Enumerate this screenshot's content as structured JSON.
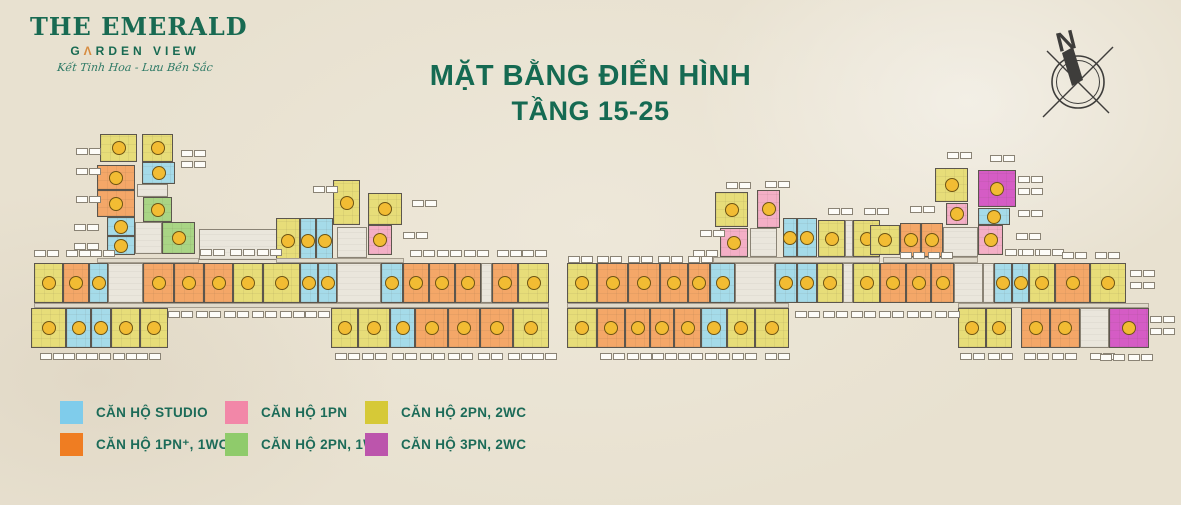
{
  "logo": {
    "line1": "THE EMERALD",
    "line2_pre": "G",
    "line2_a": "Λ",
    "line2_post": "RDEN VIEW",
    "tagline": "Kết Tinh Hoa - Lưu Bền Sắc"
  },
  "title": {
    "line1": "MẶT BẰNG  ĐIỂN HÌNH",
    "line2": "TẦNG 15-25"
  },
  "compass": {
    "label": "N"
  },
  "legend": {
    "items": [
      {
        "key": "studio",
        "label": "CĂN HỘ STUDIO",
        "color": "#7FCCEB"
      },
      {
        "key": "1pn_plus",
        "label": "CĂN HỘ 1PN⁺, 1WC",
        "color": "#EF7D22"
      },
      {
        "key": "1pn",
        "label": "CĂN HỘ 1PN",
        "color": "#F287A8"
      },
      {
        "key": "2pn_1wc",
        "label": "CĂN HỘ 2PN, 1WC",
        "color": "#8FCB6B"
      },
      {
        "key": "2pn_2wc",
        "label": "CĂN HỘ 2PN, 2WC",
        "color": "#D6C937"
      },
      {
        "key": "3pn_2wc",
        "label": "CĂN HỘ 3PN, 2WC",
        "color": "#BC55AC"
      }
    ]
  },
  "plan": {
    "fill_colors": {
      "st": "#A5DBE9",
      "o": "#F4A768",
      "p": "#F4AFC6",
      "g": "#A9D585",
      "y": "#E7DD79",
      "m": "#D55CC5",
      "c": "#EAE6DC",
      "h": "#E0DACB"
    },
    "badge": {
      "fill": "#F2BC33",
      "border": "#6E5413"
    },
    "units": [
      {
        "t": "y",
        "x": 100,
        "y": 134,
        "w": 37,
        "h": 28
      },
      {
        "t": "y",
        "x": 142,
        "y": 134,
        "w": 31,
        "h": 28
      },
      {
        "t": "o",
        "x": 97,
        "y": 165,
        "w": 38,
        "h": 25
      },
      {
        "t": "o",
        "x": 97,
        "y": 190,
        "w": 38,
        "h": 27
      },
      {
        "t": "st",
        "x": 142,
        "y": 162,
        "w": 33,
        "h": 22
      },
      {
        "t": "c",
        "x": 137,
        "y": 184,
        "w": 31,
        "h": 13
      },
      {
        "t": "st",
        "x": 107,
        "y": 217,
        "w": 28,
        "h": 19
      },
      {
        "t": "st",
        "x": 107,
        "y": 236,
        "w": 28,
        "h": 19
      },
      {
        "t": "g",
        "x": 143,
        "y": 197,
        "w": 29,
        "h": 25
      },
      {
        "t": "g",
        "x": 162,
        "y": 222,
        "w": 33,
        "h": 32
      },
      {
        "t": "c",
        "x": 135,
        "y": 222,
        "w": 27,
        "h": 32
      },
      {
        "t": "h",
        "x": 97,
        "y": 258,
        "w": 102,
        "h": 5
      },
      {
        "t": "c",
        "x": 199,
        "y": 229,
        "w": 78,
        "h": 31
      },
      {
        "t": "y",
        "x": 333,
        "y": 180,
        "w": 27,
        "h": 45
      },
      {
        "t": "y",
        "x": 368,
        "y": 193,
        "w": 34,
        "h": 32
      },
      {
        "t": "p",
        "x": 368,
        "y": 225,
        "w": 24,
        "h": 30
      },
      {
        "t": "c",
        "x": 337,
        "y": 227,
        "w": 30,
        "h": 31
      },
      {
        "t": "y",
        "x": 276,
        "y": 218,
        "w": 24,
        "h": 45
      },
      {
        "t": "st",
        "x": 300,
        "y": 218,
        "w": 16,
        "h": 45
      },
      {
        "t": "st",
        "x": 316,
        "y": 218,
        "w": 17,
        "h": 45
      },
      {
        "t": "h",
        "x": 276,
        "y": 258,
        "w": 128,
        "h": 5
      },
      {
        "t": "y",
        "x": 34,
        "y": 263,
        "w": 29,
        "h": 40
      },
      {
        "t": "o",
        "x": 63,
        "y": 263,
        "w": 26,
        "h": 40
      },
      {
        "t": "st",
        "x": 89,
        "y": 263,
        "w": 19,
        "h": 40
      },
      {
        "t": "c",
        "x": 108,
        "y": 263,
        "w": 35,
        "h": 40
      },
      {
        "t": "o",
        "x": 143,
        "y": 263,
        "w": 31,
        "h": 40
      },
      {
        "t": "o",
        "x": 174,
        "y": 263,
        "w": 30,
        "h": 40
      },
      {
        "t": "o",
        "x": 204,
        "y": 263,
        "w": 29,
        "h": 40
      },
      {
        "t": "y",
        "x": 233,
        "y": 263,
        "w": 30,
        "h": 40
      },
      {
        "t": "y",
        "x": 263,
        "y": 263,
        "w": 37,
        "h": 40
      },
      {
        "t": "st",
        "x": 300,
        "y": 263,
        "w": 18,
        "h": 40
      },
      {
        "t": "st",
        "x": 318,
        "y": 263,
        "w": 19,
        "h": 40
      },
      {
        "t": "c",
        "x": 337,
        "y": 263,
        "w": 44,
        "h": 40
      },
      {
        "t": "st",
        "x": 381,
        "y": 263,
        "w": 22,
        "h": 40
      },
      {
        "t": "o",
        "x": 403,
        "y": 263,
        "w": 26,
        "h": 40
      },
      {
        "t": "o",
        "x": 429,
        "y": 263,
        "w": 26,
        "h": 40
      },
      {
        "t": "o",
        "x": 455,
        "y": 263,
        "w": 26,
        "h": 40
      },
      {
        "t": "c",
        "x": 481,
        "y": 263,
        "w": 11,
        "h": 40
      },
      {
        "t": "o",
        "x": 492,
        "y": 263,
        "w": 26,
        "h": 40
      },
      {
        "t": "y",
        "x": 518,
        "y": 263,
        "w": 31,
        "h": 40
      },
      {
        "t": "h",
        "x": 34,
        "y": 303,
        "w": 515,
        "h": 5
      },
      {
        "t": "y",
        "x": 31,
        "y": 308,
        "w": 35,
        "h": 40
      },
      {
        "t": "st",
        "x": 66,
        "y": 308,
        "w": 25,
        "h": 40
      },
      {
        "t": "st",
        "x": 91,
        "y": 308,
        "w": 20,
        "h": 40
      },
      {
        "t": "y",
        "x": 111,
        "y": 308,
        "w": 29,
        "h": 40
      },
      {
        "t": "y",
        "x": 140,
        "y": 308,
        "w": 28,
        "h": 40
      },
      {
        "t": "y",
        "x": 331,
        "y": 308,
        "w": 27,
        "h": 40
      },
      {
        "t": "y",
        "x": 358,
        "y": 308,
        "w": 32,
        "h": 40
      },
      {
        "t": "st",
        "x": 390,
        "y": 308,
        "w": 25,
        "h": 40
      },
      {
        "t": "o",
        "x": 415,
        "y": 308,
        "w": 33,
        "h": 40
      },
      {
        "t": "o",
        "x": 448,
        "y": 308,
        "w": 32,
        "h": 40
      },
      {
        "t": "o",
        "x": 480,
        "y": 308,
        "w": 33,
        "h": 40
      },
      {
        "t": "y",
        "x": 513,
        "y": 308,
        "w": 36,
        "h": 40
      },
      {
        "t": "y",
        "x": 715,
        "y": 192,
        "w": 33,
        "h": 35
      },
      {
        "t": "p",
        "x": 757,
        "y": 190,
        "w": 23,
        "h": 38
      },
      {
        "t": "p",
        "x": 720,
        "y": 228,
        "w": 28,
        "h": 29
      },
      {
        "t": "c",
        "x": 750,
        "y": 228,
        "w": 27,
        "h": 29
      },
      {
        "t": "st",
        "x": 783,
        "y": 218,
        "w": 14,
        "h": 39
      },
      {
        "t": "st",
        "x": 797,
        "y": 218,
        "w": 20,
        "h": 39
      },
      {
        "t": "y",
        "x": 818,
        "y": 220,
        "w": 27,
        "h": 37
      },
      {
        "t": "c",
        "x": 845,
        "y": 220,
        "w": 8,
        "h": 37
      },
      {
        "t": "y",
        "x": 853,
        "y": 220,
        "w": 27,
        "h": 37
      },
      {
        "t": "h",
        "x": 713,
        "y": 257,
        "w": 167,
        "h": 6
      },
      {
        "t": "y",
        "x": 935,
        "y": 168,
        "w": 33,
        "h": 34
      },
      {
        "t": "m",
        "x": 978,
        "y": 170,
        "w": 38,
        "h": 37
      },
      {
        "t": "p",
        "x": 946,
        "y": 203,
        "w": 22,
        "h": 22
      },
      {
        "t": "st",
        "x": 978,
        "y": 208,
        "w": 32,
        "h": 17
      },
      {
        "t": "p",
        "x": 978,
        "y": 225,
        "w": 25,
        "h": 30
      },
      {
        "t": "y",
        "x": 870,
        "y": 225,
        "w": 30,
        "h": 30
      },
      {
        "t": "o",
        "x": 900,
        "y": 223,
        "w": 21,
        "h": 34
      },
      {
        "t": "o",
        "x": 921,
        "y": 223,
        "w": 22,
        "h": 34
      },
      {
        "t": "c",
        "x": 943,
        "y": 227,
        "w": 35,
        "h": 30
      },
      {
        "t": "h",
        "x": 883,
        "y": 257,
        "w": 95,
        "h": 6
      },
      {
        "t": "y",
        "x": 567,
        "y": 263,
        "w": 30,
        "h": 40
      },
      {
        "t": "o",
        "x": 597,
        "y": 263,
        "w": 31,
        "h": 40
      },
      {
        "t": "o",
        "x": 628,
        "y": 263,
        "w": 32,
        "h": 40
      },
      {
        "t": "o",
        "x": 660,
        "y": 263,
        "w": 28,
        "h": 40
      },
      {
        "t": "o",
        "x": 688,
        "y": 263,
        "w": 22,
        "h": 40
      },
      {
        "t": "st",
        "x": 710,
        "y": 263,
        "w": 25,
        "h": 40
      },
      {
        "t": "c",
        "x": 735,
        "y": 263,
        "w": 40,
        "h": 40
      },
      {
        "t": "st",
        "x": 775,
        "y": 263,
        "w": 22,
        "h": 40
      },
      {
        "t": "st",
        "x": 797,
        "y": 263,
        "w": 20,
        "h": 40
      },
      {
        "t": "y",
        "x": 817,
        "y": 263,
        "w": 26,
        "h": 40
      },
      {
        "t": "c",
        "x": 843,
        "y": 263,
        "w": 10,
        "h": 40
      },
      {
        "t": "y",
        "x": 853,
        "y": 263,
        "w": 27,
        "h": 40
      },
      {
        "t": "o",
        "x": 880,
        "y": 263,
        "w": 26,
        "h": 40
      },
      {
        "t": "o",
        "x": 906,
        "y": 263,
        "w": 25,
        "h": 40
      },
      {
        "t": "o",
        "x": 931,
        "y": 263,
        "w": 23,
        "h": 40
      },
      {
        "t": "c",
        "x": 954,
        "y": 263,
        "w": 29,
        "h": 40
      },
      {
        "t": "c",
        "x": 983,
        "y": 263,
        "w": 11,
        "h": 40
      },
      {
        "t": "st",
        "x": 994,
        "y": 263,
        "w": 18,
        "h": 40
      },
      {
        "t": "st",
        "x": 1012,
        "y": 263,
        "w": 17,
        "h": 40
      },
      {
        "t": "y",
        "x": 1029,
        "y": 263,
        "w": 26,
        "h": 40
      },
      {
        "t": "o",
        "x": 1055,
        "y": 263,
        "w": 35,
        "h": 40
      },
      {
        "t": "y",
        "x": 1090,
        "y": 263,
        "w": 36,
        "h": 40
      },
      {
        "t": "h",
        "x": 567,
        "y": 303,
        "w": 222,
        "h": 5
      },
      {
        "t": "h",
        "x": 958,
        "y": 303,
        "w": 191,
        "h": 5
      },
      {
        "t": "y",
        "x": 567,
        "y": 308,
        "w": 30,
        "h": 40
      },
      {
        "t": "o",
        "x": 597,
        "y": 308,
        "w": 28,
        "h": 40
      },
      {
        "t": "o",
        "x": 625,
        "y": 308,
        "w": 25,
        "h": 40
      },
      {
        "t": "o",
        "x": 650,
        "y": 308,
        "w": 24,
        "h": 40
      },
      {
        "t": "o",
        "x": 674,
        "y": 308,
        "w": 27,
        "h": 40
      },
      {
        "t": "st",
        "x": 701,
        "y": 308,
        "w": 26,
        "h": 40
      },
      {
        "t": "y",
        "x": 727,
        "y": 308,
        "w": 28,
        "h": 40
      },
      {
        "t": "y",
        "x": 755,
        "y": 308,
        "w": 34,
        "h": 40
      },
      {
        "t": "y",
        "x": 958,
        "y": 308,
        "w": 28,
        "h": 40
      },
      {
        "t": "y",
        "x": 986,
        "y": 308,
        "w": 26,
        "h": 40
      },
      {
        "t": "o",
        "x": 1021,
        "y": 308,
        "w": 29,
        "h": 40
      },
      {
        "t": "o",
        "x": 1050,
        "y": 308,
        "w": 30,
        "h": 40
      },
      {
        "t": "c",
        "x": 1080,
        "y": 308,
        "w": 29,
        "h": 40
      },
      {
        "t": "m",
        "x": 1109,
        "y": 308,
        "w": 40,
        "h": 40
      }
    ],
    "labels": [
      [
        34,
        250
      ],
      [
        66,
        250
      ],
      [
        90,
        250
      ],
      [
        200,
        249
      ],
      [
        230,
        249
      ],
      [
        257,
        249
      ],
      [
        410,
        250
      ],
      [
        437,
        250
      ],
      [
        464,
        250
      ],
      [
        497,
        250
      ],
      [
        522,
        250
      ],
      [
        76,
        148
      ],
      [
        76,
        168
      ],
      [
        76,
        196
      ],
      [
        74,
        224
      ],
      [
        74,
        243
      ],
      [
        181,
        150
      ],
      [
        181,
        161
      ],
      [
        313,
        186
      ],
      [
        412,
        200
      ],
      [
        403,
        232
      ],
      [
        168,
        311
      ],
      [
        196,
        311
      ],
      [
        224,
        311
      ],
      [
        252,
        311
      ],
      [
        280,
        311
      ],
      [
        305,
        311
      ],
      [
        40,
        353
      ],
      [
        63,
        353
      ],
      [
        86,
        353
      ],
      [
        113,
        353
      ],
      [
        136,
        353
      ],
      [
        335,
        353
      ],
      [
        362,
        353
      ],
      [
        392,
        353
      ],
      [
        420,
        353
      ],
      [
        448,
        353
      ],
      [
        478,
        353
      ],
      [
        508,
        353
      ],
      [
        532,
        353
      ],
      [
        568,
        256
      ],
      [
        597,
        256
      ],
      [
        628,
        256
      ],
      [
        658,
        256
      ],
      [
        688,
        256
      ],
      [
        900,
        252
      ],
      [
        928,
        252
      ],
      [
        726,
        182
      ],
      [
        765,
        181
      ],
      [
        828,
        208
      ],
      [
        864,
        208
      ],
      [
        700,
        230
      ],
      [
        693,
        250
      ],
      [
        947,
        152
      ],
      [
        990,
        155
      ],
      [
        1018,
        176
      ],
      [
        1018,
        188
      ],
      [
        1018,
        210
      ],
      [
        1016,
        233
      ],
      [
        910,
        206
      ],
      [
        1005,
        249
      ],
      [
        1022,
        249
      ],
      [
        1039,
        249
      ],
      [
        1062,
        252
      ],
      [
        1095,
        252
      ],
      [
        795,
        311
      ],
      [
        823,
        311
      ],
      [
        851,
        311
      ],
      [
        879,
        311
      ],
      [
        907,
        311
      ],
      [
        935,
        311
      ],
      [
        600,
        353
      ],
      [
        627,
        353
      ],
      [
        652,
        353
      ],
      [
        678,
        353
      ],
      [
        705,
        353
      ],
      [
        732,
        353
      ],
      [
        765,
        353
      ],
      [
        960,
        353
      ],
      [
        988,
        353
      ],
      [
        1024,
        353
      ],
      [
        1052,
        353
      ],
      [
        1090,
        353
      ],
      [
        1100,
        354
      ],
      [
        1128,
        354
      ],
      [
        1130,
        270
      ],
      [
        1130,
        282
      ],
      [
        1150,
        316
      ],
      [
        1150,
        328
      ]
    ]
  }
}
